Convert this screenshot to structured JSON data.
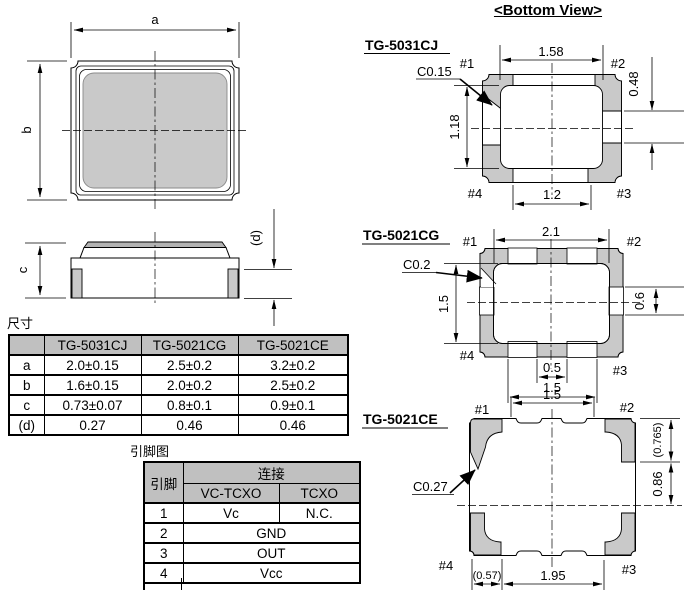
{
  "titles": {
    "bottom_view": "<Bottom View>",
    "dim_table": "尺寸",
    "pin_table": "引脚图"
  },
  "top_view": {
    "a": "a",
    "b": "b"
  },
  "side_view": {
    "c": "c",
    "d": "(d)"
  },
  "dim_table": {
    "columns": [
      "",
      "TG-5031CJ",
      "TG-5021CG",
      "TG-5021CE"
    ],
    "rows": [
      {
        "label": "a",
        "values": [
          "2.0±0.15",
          "2.5±0.2",
          "3.2±0.2"
        ]
      },
      {
        "label": "b",
        "values": [
          "1.6±0.15",
          "2.0±0.2",
          "2.5±0.2"
        ]
      },
      {
        "label": "c",
        "values": [
          "0.73±0.07",
          "0.8±0.1",
          "0.9±0.1"
        ]
      },
      {
        "label": "(d)",
        "values": [
          "0.27",
          "0.46",
          "0.46"
        ]
      }
    ]
  },
  "pin_table": {
    "pin_header": "引脚",
    "connection_header": "连接",
    "sub_headers": [
      "VC-TCXO",
      "TCXO"
    ],
    "rows": [
      {
        "pin": "1",
        "vc_tcxo": "Vc",
        "tcxo": "N.C."
      },
      {
        "pin": "2",
        "value": "GND"
      },
      {
        "pin": "3",
        "value": "OUT"
      },
      {
        "pin": "4",
        "value": "Vcc"
      }
    ]
  },
  "views": {
    "tg5031cj": {
      "name": "TG-5031CJ",
      "chamfer": "C0.15",
      "dim_top": "1.58",
      "dim_left": "1.18",
      "dim_right": "0.48",
      "dim_bottom": "1.2",
      "pin1": "#1",
      "pin2": "#2",
      "pin3": "#3",
      "pin4": "#4"
    },
    "tg5021cg": {
      "name": "TG-5021CG",
      "chamfer": "C0.2",
      "dim_top": "2.1",
      "dim_left": "1.5",
      "dim_right": "0.6",
      "dim_bottom_inner": "0.5",
      "dim_bottom": "1.5",
      "pin1": "#1",
      "pin2": "#2",
      "pin3": "#3",
      "pin4": "#4"
    },
    "tg5021ce": {
      "name": "TG-5021CE",
      "chamfer": "C0.27",
      "dim_top": "1.5",
      "dim_right_top": "(0.765)",
      "dim_right": "0.86",
      "dim_bottom_left": "(0.57)",
      "dim_bottom": "1.95",
      "pin1": "#1",
      "pin2": "#2",
      "pin3": "#3",
      "pin4": "#4"
    }
  },
  "colors": {
    "pad_fill": "#c9c9c9",
    "lid_fill": "#b3b3b3",
    "table_header": "#c0c0c0",
    "line": "#000000"
  }
}
